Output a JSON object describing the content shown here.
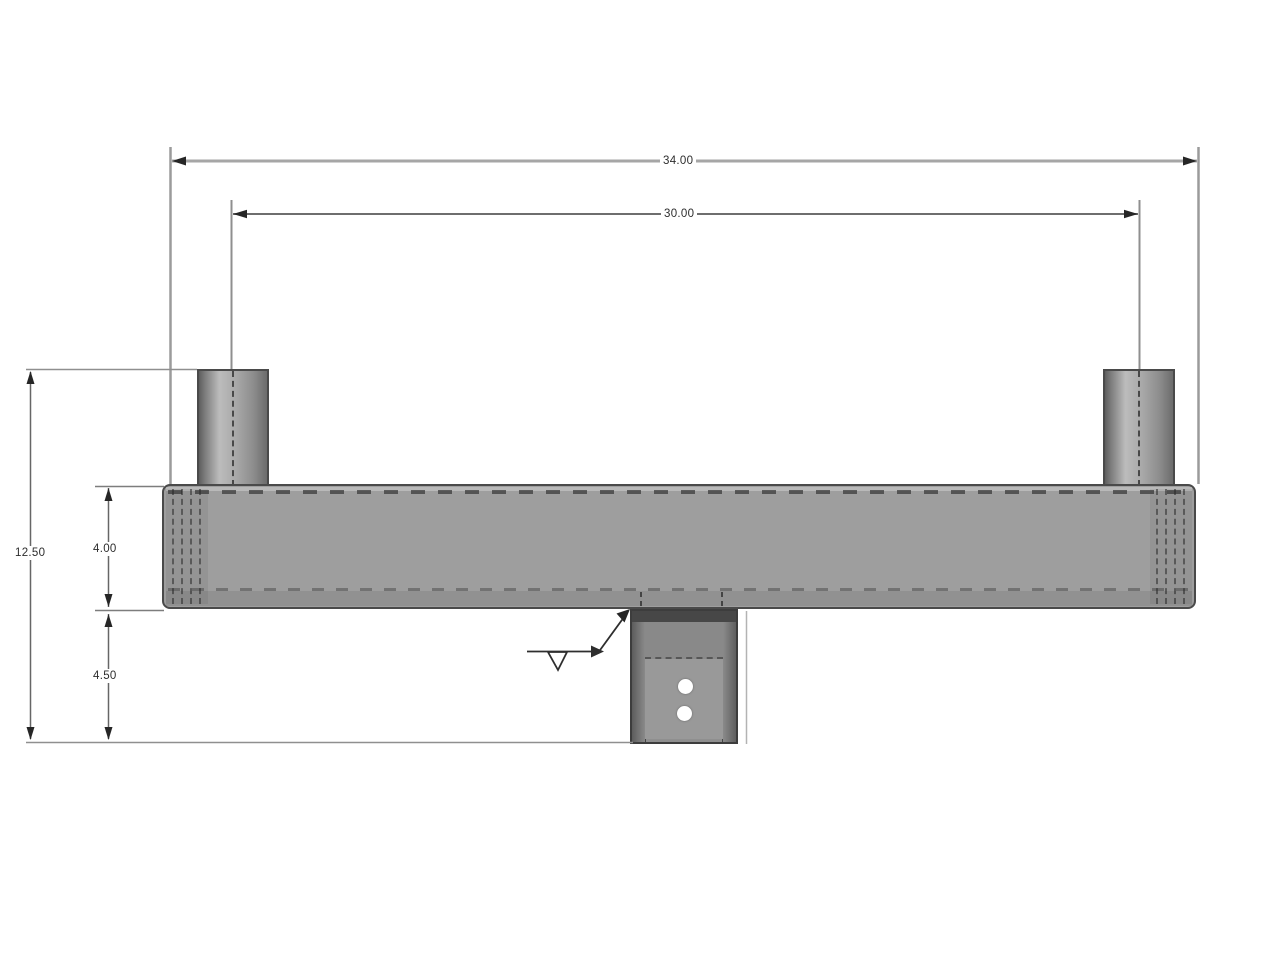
{
  "dims": {
    "overall_width": "34.00",
    "tenon_spacing": "30.00",
    "overall_height": "12.50",
    "bar_height": "4.00",
    "mount_drop": "4.50"
  },
  "colors": {
    "part_gray": "#9e9e9e",
    "outline": "#4a4a4a",
    "dimension_line": "#666666",
    "background": "#ffffff"
  },
  "symbols": {
    "weld_symbol": "fillet-weld"
  }
}
